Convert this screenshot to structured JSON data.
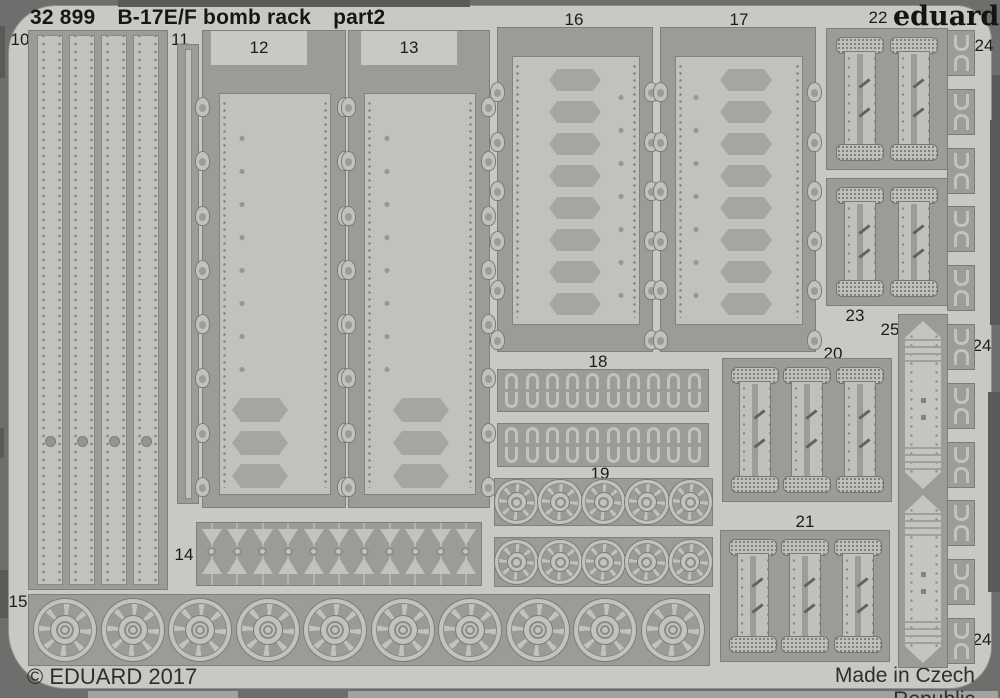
{
  "header": {
    "code": "32 899",
    "title": "B-17E/F bomb rack",
    "part": "part2"
  },
  "brand": {
    "logo": "eduard"
  },
  "footer": {
    "copyright": "© EDUARD 2017",
    "origin": "Made in Czech Republic"
  },
  "parts": {
    "p10": "10",
    "p11": "11",
    "p12": "12",
    "p13": "13",
    "p14": "14",
    "p15": "15",
    "p16": "16",
    "p17": "17",
    "p18": "18",
    "p19": "19",
    "p20": "20",
    "p21": "21",
    "p22": "22",
    "p23": "23",
    "p24_top": "24",
    "p24_mid": "24",
    "p24_bottom": "24",
    "p25": "25"
  },
  "colors": {
    "photo_background": "#6e6e6c",
    "fret_metal": "#c8c8c4",
    "etched_panel": "#9b9b97",
    "part_metal": "#c1c1bd",
    "recess_pad": "#a6a6a0",
    "text": "#161614"
  }
}
